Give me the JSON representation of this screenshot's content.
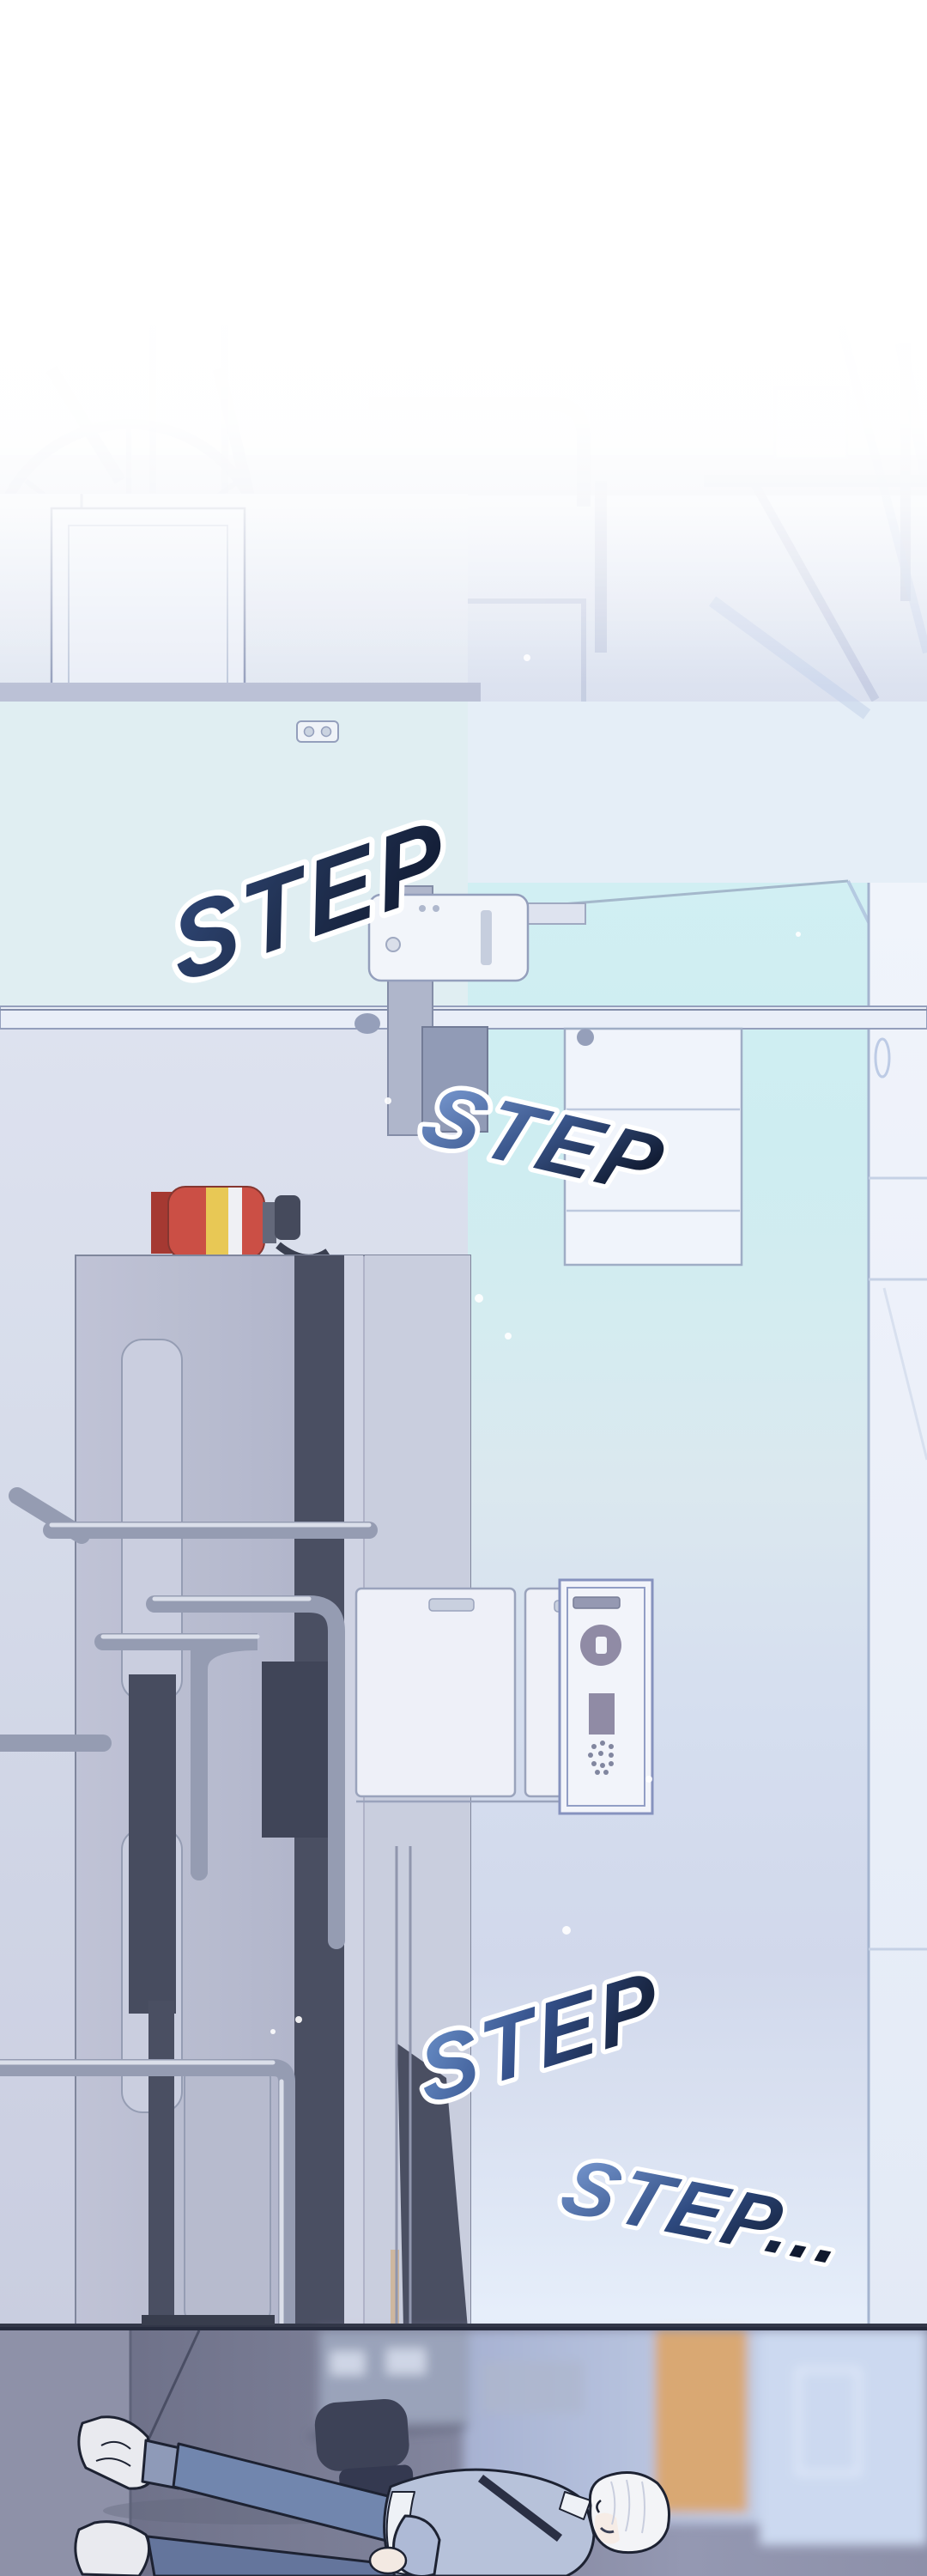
{
  "panel": {
    "medium": "webtoon comic panel",
    "scene_description": "Hospital corridor interior rotated 90 degrees; a boy with white hair walks past a hospital bed, a fire extinguisher and wall cabinets; the scene fades to white haze at the top and darkens near the floor at the bottom.",
    "sfx": [
      {
        "text": "STEP"
      },
      {
        "text": "STEP"
      },
      {
        "text": "STEP"
      },
      {
        "text": "STEP..."
      }
    ],
    "palette": {
      "haze_white": "#ffffff",
      "wall_lavender": "#ccd3e8",
      "wall_mint": "#dfedf2",
      "floor_teal": "#cfeef3",
      "sfx_blue_light": "#7fa0d8",
      "sfx_navy_dark": "#16223c",
      "sfx_outline_white": "#ffffff",
      "extinguisher_red": "#c8443a",
      "extinguisher_band_yellow": "#e7c54b",
      "bed_gray": "#b2b6cb",
      "bed_stripe_dark": "#3f4459",
      "rail_metal": "#8f96ae",
      "cabinet_white": "#f0f4fb",
      "panel_button_purple": "#8a84a0",
      "lower_floor_gray": "#7e8199",
      "lower_wall_gray": "#8e91a8",
      "door_tan": "#d9a873",
      "chair_dark": "#3d4257",
      "jeans_blue": "#7186ae",
      "jacket_blue": "#b7c2da",
      "hair_white": "#f3f4f7"
    },
    "objects": [
      "ghost-wheelchair",
      "ceiling-band",
      "door-panel",
      "wall-outlet",
      "patient-monitor",
      "handrail",
      "fire-extinguisher",
      "hospital-bed",
      "bed-rails",
      "cabinet-doors",
      "wall-control-panel",
      "corridor-floor",
      "wall-panel-lines",
      "sparkles",
      "lower-corridor",
      "office-chair",
      "background-shelf",
      "tan-door",
      "walking-person"
    ]
  }
}
